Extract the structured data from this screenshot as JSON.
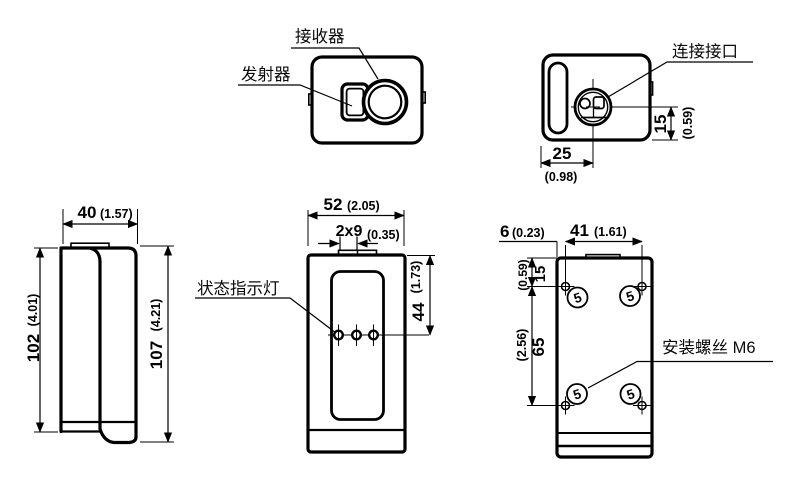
{
  "drawing": {
    "background": "#ffffff",
    "line_color": "#000000",
    "views": {
      "top": {
        "receiver_label": "接收器",
        "transmitter_label": "发射器"
      },
      "connector": {
        "label": "连接接口",
        "width_mm": "25",
        "width_in": "(0.98)",
        "height_mm": "15",
        "height_in": "(0.59)"
      },
      "side": {
        "width_mm": "40",
        "width_in": "(1.57)",
        "body_height_mm": "102",
        "body_height_in": "(4.01)",
        "total_height_mm": "107",
        "total_height_in": "(4.21)"
      },
      "front": {
        "status_led_label": "状态指示灯",
        "width_mm": "52",
        "width_in": "(2.05)",
        "tab_mm": "2x9",
        "tab_in": "(0.35)",
        "window_height_mm": "44",
        "window_height_in": "(1.73)"
      },
      "back": {
        "mounting_screw_label": "安装螺丝 M6",
        "screw_size_mark": "5",
        "edge_offset_mm": "6",
        "edge_offset_in": "(0.23)",
        "hole_spacing_h_mm": "41",
        "hole_spacing_h_in": "(1.61)",
        "hole_top_offset_mm": "15",
        "hole_top_offset_in": "(0.59)",
        "hole_spacing_v_mm": "65",
        "hole_spacing_v_in": "(2.56)"
      }
    }
  }
}
